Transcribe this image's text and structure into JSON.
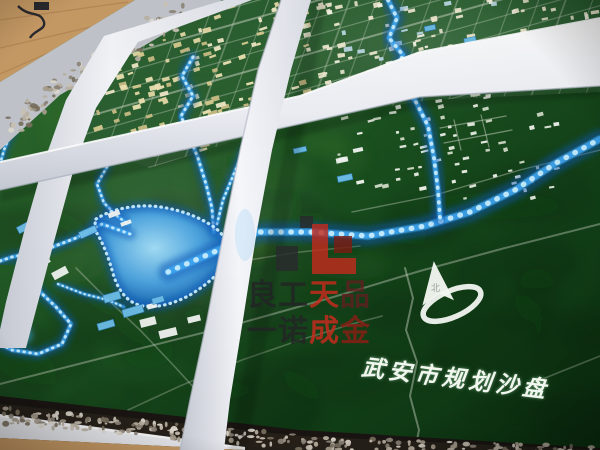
{
  "overlay": {
    "title": {
      "text": "武安市规划沙盘",
      "chars": [
        "武",
        "安",
        "市",
        "规",
        "划",
        "沙",
        "盘"
      ]
    },
    "watermark": {
      "line1": [
        {
          "ch": "良",
          "color": "#232326"
        },
        {
          "ch": "工",
          "color": "#232326"
        },
        {
          "ch": "天",
          "color": "#cf2a1e"
        },
        {
          "ch": "品",
          "color": "#5f2020"
        }
      ],
      "line2": [
        {
          "ch": "一",
          "color": "#232326"
        },
        {
          "ch": "诺",
          "color": "#232326"
        },
        {
          "ch": "成",
          "color": "#cf2a1e"
        },
        {
          "ch": "金",
          "color": "#8e1d14"
        }
      ],
      "logo_blocks": [
        {
          "x": 6,
          "y": 34,
          "w": 22,
          "h": 25,
          "c": "#2a2a2e"
        },
        {
          "x": 30,
          "y": 4,
          "w": 13,
          "h": 12,
          "c": "#2a2a2e"
        },
        {
          "x": 42,
          "y": 12,
          "w": 16,
          "h": 50,
          "c": "#c32a1c"
        },
        {
          "x": 64,
          "y": 24,
          "w": 18,
          "h": 17,
          "c": "#7e1b12"
        },
        {
          "x": 46,
          "y": 46,
          "w": 40,
          "h": 16,
          "c": "#c32a1c"
        }
      ]
    },
    "compass_label": "北"
  },
  "palette": {
    "green_light": "#327032",
    "green_mid": "#1d5422",
    "green_dark": "#123f17",
    "green_deep": "#06220b",
    "city_green": "#2c6132",
    "led_core": "#c8eeff",
    "led_mid": "#3fa9f5",
    "led_glow": "#0a58b8",
    "lake_hi": "#a8e2ff",
    "lake_mid": "#4fa8e8",
    "lake_lo": "#0c4488",
    "beam_white": "#f4f5f9",
    "beam_face": "#d7dae2",
    "beam_shade": "#b9bdc9",
    "wood": "#c99c66",
    "wood_dark": "#a87c4a",
    "rim": "#c3c7cd",
    "road": "#cfd8c8",
    "watermark_red": "#c32a1c",
    "watermark_black": "#2a2a2e",
    "title_white": "#f1f7ee",
    "pebbles": [
      "#cdc6b8",
      "#a99f8f",
      "#e2dcd1",
      "#8e8679",
      "#bcb3a4",
      "#79715f"
    ]
  },
  "scene": {
    "city_polygon": [
      [
        222,
        0
      ],
      [
        600,
        0
      ],
      [
        600,
        92
      ],
      [
        430,
        100
      ],
      [
        300,
        120
      ],
      [
        150,
        168
      ],
      [
        92,
        148
      ],
      [
        76,
        120
      ],
      [
        100,
        40
      ]
    ],
    "grid": {
      "a_start": -6,
      "a_gap": 17,
      "a_count": 15,
      "b_start": 60,
      "b_gap": 27,
      "b_count": 21
    },
    "clusters": [
      {
        "name": "old-town",
        "x": 98,
        "y": 4,
        "w": 212,
        "h": 152,
        "angle": -17,
        "count": 185,
        "wMin": 3,
        "wMax": 10,
        "hMin": 2,
        "hMax": 5,
        "seed": 7,
        "clip": true,
        "colors": [
          "#e6d9a8",
          "#f0e9c8",
          "#d9cc92",
          "#eee4b4",
          "#c9bd86"
        ]
      },
      {
        "name": "new-district",
        "x": 302,
        "y": 0,
        "w": 298,
        "h": 88,
        "angle": -12,
        "count": 125,
        "wMin": 3,
        "wMax": 9,
        "hMin": 2,
        "hMax": 5,
        "seed": 11,
        "clip": true,
        "colors": [
          "#ece7cc",
          "#f6f4e6",
          "#bcd9e6",
          "#e2e0c8",
          "#f0ead2"
        ]
      },
      {
        "name": "east-suburb",
        "x": 335,
        "y": 94,
        "w": 232,
        "h": 106,
        "angle": -12,
        "count": 72,
        "wMin": 3,
        "wMax": 8,
        "hMin": 2,
        "hMax": 4,
        "seed": 5,
        "clip": false,
        "colors": [
          "#e8eee4",
          "#f4f7f0",
          "#d2dcc8"
        ]
      }
    ],
    "white_buildings": [
      [
        43,
        262,
        14,
        7,
        -28
      ],
      [
        60,
        273,
        16,
        8,
        -28
      ],
      [
        114,
        214,
        12,
        5,
        -20
      ],
      [
        126,
        223,
        11,
        4,
        -20
      ],
      [
        148,
        322,
        16,
        8,
        -14
      ],
      [
        168,
        333,
        18,
        8,
        -14
      ],
      [
        194,
        319,
        13,
        6,
        -14
      ],
      [
        152,
        306,
        10,
        5,
        -14
      ],
      [
        210,
        331,
        10,
        5,
        -14
      ],
      [
        342,
        160,
        12,
        5,
        -12
      ],
      [
        358,
        150,
        10,
        4,
        -12
      ]
    ],
    "factories": [
      [
        25,
        227,
        16,
        7,
        -28
      ],
      [
        88,
        232,
        18,
        7,
        -24
      ],
      [
        28,
        297,
        17,
        7,
        -20
      ],
      [
        112,
        297,
        17,
        8,
        -16
      ],
      [
        133,
        311,
        21,
        8,
        -16
      ],
      [
        106,
        325,
        17,
        7,
        -16
      ],
      [
        158,
        300,
        12,
        6,
        -16
      ],
      [
        300,
        150,
        13,
        5,
        -12
      ],
      [
        345,
        178,
        15,
        6,
        -12
      ],
      [
        470,
        40,
        12,
        5,
        -12
      ],
      [
        430,
        28,
        11,
        5,
        -12
      ]
    ],
    "rivers": [
      {
        "name": "main-led-river",
        "w": 7,
        "pts": [
          [
            168,
            272
          ],
          [
            214,
            252
          ],
          [
            258,
            232
          ],
          [
            310,
            232
          ],
          [
            368,
            236
          ],
          [
            425,
            226
          ],
          [
            470,
            212
          ],
          [
            515,
            190
          ],
          [
            556,
            163
          ],
          [
            600,
            139
          ]
        ]
      },
      {
        "name": "north-river",
        "w": 5,
        "pts": [
          [
            388,
            0
          ],
          [
            397,
            18
          ],
          [
            389,
            38
          ],
          [
            403,
            55
          ],
          [
            396,
            72
          ],
          [
            407,
            86
          ],
          [
            417,
            104
          ],
          [
            428,
            126
          ],
          [
            434,
            158
          ],
          [
            438,
            190
          ],
          [
            440,
            218
          ]
        ]
      },
      {
        "name": "city-stream",
        "w": 4,
        "pts": [
          [
            193,
            57
          ],
          [
            182,
            76
          ],
          [
            193,
            96
          ],
          [
            181,
            116
          ],
          [
            189,
            136
          ],
          [
            198,
            158
          ],
          [
            206,
            184
          ],
          [
            212,
            208
          ],
          [
            214,
            232
          ]
        ]
      },
      {
        "name": "east-branch",
        "w": 3.5,
        "pts": [
          [
            259,
            127
          ],
          [
            244,
            150
          ],
          [
            233,
            176
          ],
          [
            223,
            200
          ],
          [
            217,
            224
          ]
        ]
      },
      {
        "name": "west-branch",
        "w": 3.5,
        "pts": [
          [
            107,
            167
          ],
          [
            97,
            184
          ],
          [
            104,
            203
          ],
          [
            117,
            216
          ],
          [
            128,
            224
          ]
        ]
      },
      {
        "name": "lake-west-stream",
        "w": 4,
        "pts": [
          [
            130,
            234
          ],
          [
            102,
            224
          ],
          [
            76,
            238
          ],
          [
            42,
            251
          ],
          [
            12,
            257
          ],
          [
            0,
            261
          ]
        ]
      },
      {
        "name": "lower-left-stream",
        "w": 4,
        "pts": [
          [
            22,
            266
          ],
          [
            36,
            288
          ],
          [
            56,
            307
          ],
          [
            71,
            324
          ],
          [
            62,
            344
          ],
          [
            38,
            354
          ],
          [
            12,
            350
          ],
          [
            0,
            344
          ]
        ]
      },
      {
        "name": "edge-stream",
        "w": 3.5,
        "pts": [
          [
            26,
            106
          ],
          [
            13,
            128
          ],
          [
            4,
            150
          ],
          [
            0,
            164
          ]
        ]
      },
      {
        "name": "south-stream",
        "w": 3,
        "pts": [
          [
            58,
            284
          ],
          [
            84,
            294
          ],
          [
            108,
            300
          ],
          [
            124,
            307
          ]
        ]
      }
    ],
    "roads": [
      {
        "w": 2,
        "o": 0.4,
        "pts": [
          [
            0,
            384
          ],
          [
            110,
            356
          ],
          [
            230,
            326
          ],
          [
            330,
            298
          ],
          [
            420,
            271
          ],
          [
            505,
            248
          ],
          [
            600,
            224
          ]
        ]
      },
      {
        "w": 2,
        "o": 0.45,
        "pts": [
          [
            405,
            268
          ],
          [
            413,
            298
          ],
          [
            406,
            330
          ],
          [
            417,
            362
          ],
          [
            410,
            396
          ],
          [
            419,
            430
          ],
          [
            415,
            450
          ]
        ]
      },
      {
        "w": 1.6,
        "o": 0.35,
        "pts": [
          [
            76,
            268
          ],
          [
            104,
            296
          ],
          [
            140,
            330
          ],
          [
            176,
            368
          ],
          [
            205,
            400
          ],
          [
            228,
            432
          ],
          [
            236,
            450
          ]
        ]
      },
      {
        "w": 1.6,
        "o": 0.3,
        "pts": [
          [
            128,
            410
          ],
          [
            180,
            386
          ],
          [
            242,
            360
          ],
          [
            300,
            340
          ],
          [
            352,
            324
          ],
          [
            382,
            316
          ]
        ]
      },
      {
        "w": 1.4,
        "o": 0.4,
        "pts": [
          [
            352,
            212
          ],
          [
            432,
            196
          ],
          [
            520,
            170
          ],
          [
            600,
            150
          ]
        ]
      },
      {
        "w": 1.3,
        "o": 0.5,
        "pts": [
          [
            440,
            128
          ],
          [
            506,
            116
          ]
        ]
      },
      {
        "w": 1.3,
        "o": 0.5,
        "pts": [
          [
            444,
            143
          ],
          [
            512,
            130
          ]
        ]
      },
      {
        "w": 1.2,
        "o": 0.5,
        "pts": [
          [
            454,
            120
          ],
          [
            461,
            150
          ]
        ]
      },
      {
        "w": 1.2,
        "o": 0.5,
        "pts": [
          [
            481,
            115
          ],
          [
            489,
            147
          ]
        ]
      },
      {
        "w": 1.5,
        "o": 0.3,
        "pts": [
          [
            236,
            262
          ],
          [
            300,
            252
          ],
          [
            360,
            246
          ]
        ]
      },
      {
        "w": 1.6,
        "o": 0.35,
        "pts": [
          [
            540,
            380
          ],
          [
            600,
            356
          ]
        ]
      }
    ],
    "pebble_bands": [
      {
        "x1": 182,
        "y1": 14,
        "x2": 58,
        "y2": 86,
        "half": 13,
        "count": 100,
        "seed": 3
      },
      {
        "x1": 62,
        "y1": 84,
        "x2": 16,
        "y2": 124,
        "half": 9,
        "count": 40,
        "seed": 9
      },
      {
        "x1": 4,
        "y1": 416,
        "x2": 298,
        "y2": 442,
        "half": 8,
        "count": 150,
        "seed": 5
      },
      {
        "x1": 300,
        "y1": 443,
        "x2": 598,
        "y2": 452,
        "half": 6,
        "count": 110,
        "seed": 8
      }
    ]
  }
}
